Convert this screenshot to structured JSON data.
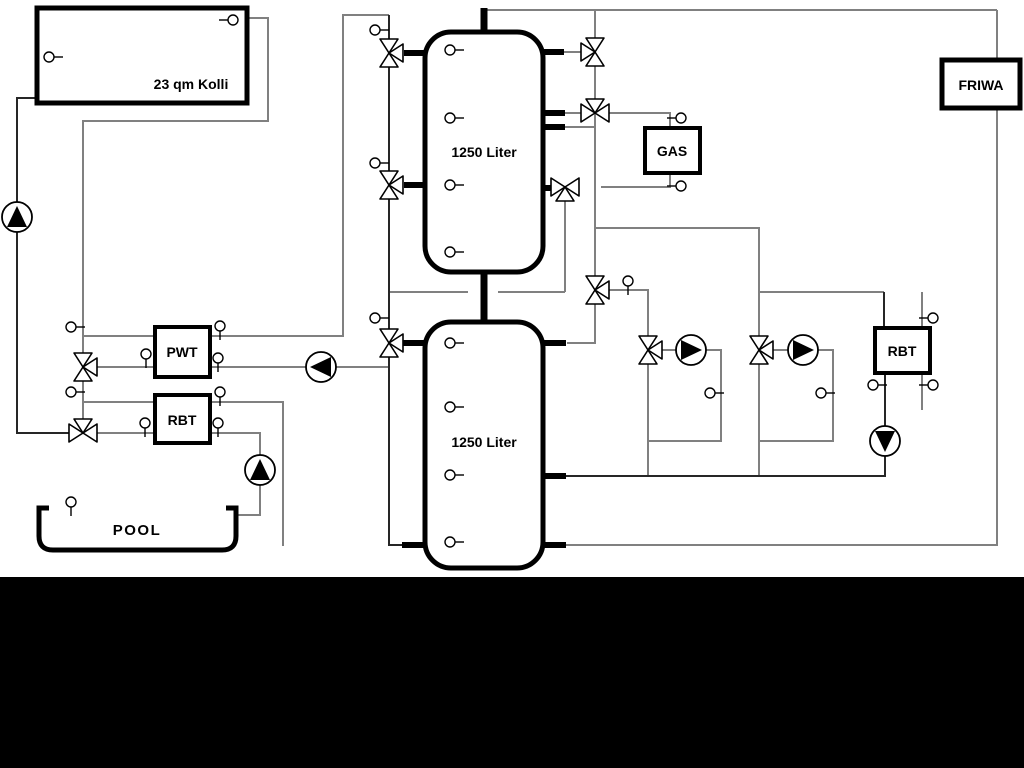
{
  "labels": {
    "collector": "23 qm Kolli",
    "upper_tank": "1250 Liter",
    "lower_tank": "1250 Liter",
    "gas_boiler": "GAS",
    "friwa_station": "FRIWA",
    "pwt_exchanger": "PWT",
    "rbt_exchanger_left": "RBT",
    "rbt_exchanger_right": "RBT",
    "pool": "POOL"
  },
  "colors": {
    "pipe_gray": "#808080",
    "pipe_dark": "#262626",
    "outline_black": "#000000",
    "background": "#ffffff",
    "bottom_band": "#000000"
  }
}
